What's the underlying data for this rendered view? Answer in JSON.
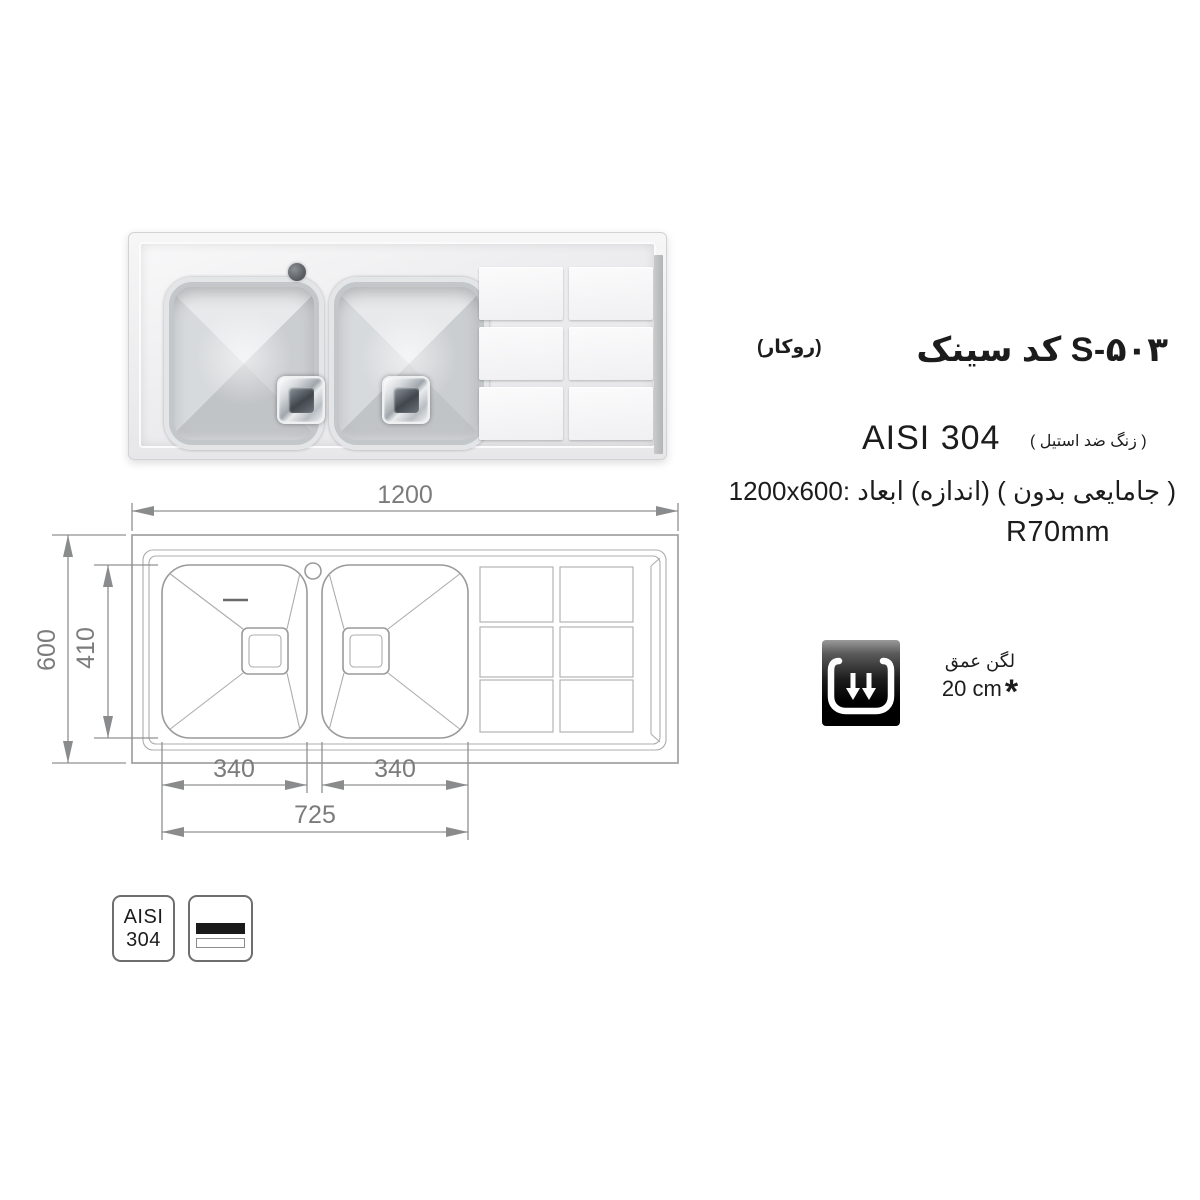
{
  "product": {
    "title": "سینک کد S-۵۰۳",
    "mount_type": "(روکار)",
    "steel_grade": "AISI 304",
    "steel_note": "( استیل ضد زنگ )",
    "size_note": "1200x600: ابعاد (اندازه) ( بدون جامایعی )",
    "corner_radius": "R70mm"
  },
  "depth_badge": {
    "label": "عمق لگن",
    "value": "20 cm",
    "footnote_mark": "*"
  },
  "drawing": {
    "overall_width": "1200",
    "overall_depth": "600",
    "bowl_inner_length": "410",
    "bowl1_width": "340",
    "bowl2_width": "340",
    "bowls_overall_width": "725"
  },
  "material_badges": {
    "grade_line1": "AISI",
    "grade_line2": "304"
  },
  "colors": {
    "drawing_line_gray": "#999a9b",
    "dimension_gray": "#7b7b7b",
    "text_black": "#1c1c1c",
    "steel_light": "#ededef"
  }
}
